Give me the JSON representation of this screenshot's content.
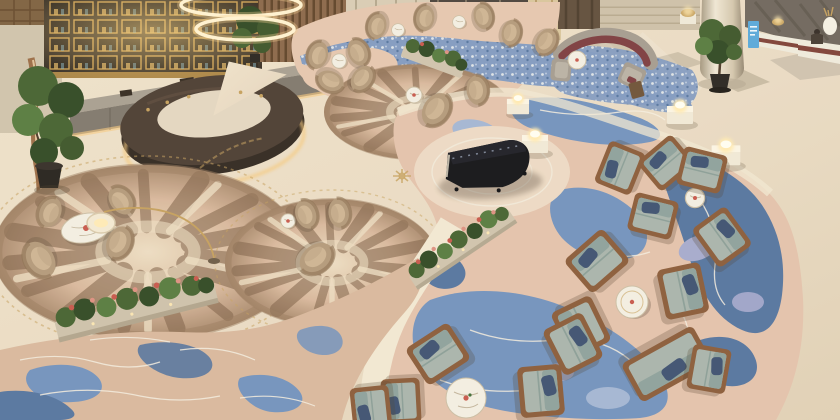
{
  "scene": {
    "title": "Hotel lobby lounge — overhead aerial view",
    "setting": "luxury hotel lobby with lounge bar, piano area and reception",
    "camera": "high-angle overhead photograph",
    "areas": [
      {
        "name": "bar-lounge",
        "description": "Illuminated gold display shelving, long grey back counter and dark marble horseshoe bar with warm under-counter lighting"
      },
      {
        "name": "chandelier",
        "description": "Two glowing LED ring chandeliers suspended above the bar"
      },
      {
        "name": "tan-seating",
        "description": "Tan barrel tub chairs with small round marble tables arranged on circular brush-stroke rugs"
      },
      {
        "name": "piano-stage",
        "description": "Black grand piano with open lid standing on a pale medallion of the blue marbled carpet"
      },
      {
        "name": "blue-carpet-lounge",
        "description": "Wood-frame armchairs with sage-green cushions and navy pillows around white marble tables on a blue-and-blush marbled carpet"
      },
      {
        "name": "reception",
        "description": "White stone reception desks with dark red accent band, attendant on duty and a blue standing information sign"
      },
      {
        "name": "greenery",
        "description": "Potted ficus trees and long planter boxes filled with red and pink flowers"
      }
    ],
    "objects": {
      "grand_piano": 1,
      "ring_chandeliers": 2,
      "tan_tub_chairs": 18,
      "wood_frame_armchairs": 13,
      "loveseat_sofas": 1,
      "curved_sofa_maroon": 1,
      "marble_tables": 11,
      "glowing_display_pedestals": 4,
      "flower_planters": 3,
      "potted_trees": 3,
      "reception_desks": 2,
      "staff": 1,
      "blue_info_sign": 1,
      "circular_rugs": 3
    }
  },
  "palette": {
    "floor": "#e9dac3",
    "floorWarm": "#f0e3cd",
    "walkway": "#f2e7d2",
    "wallBrown": "#7d5f3f",
    "goldShelf": "#c79a4e",
    "shelfDark": "#332a22",
    "counterGray": "#a79d90",
    "cabinetGray": "#7f766c",
    "barTop": "#4a3b31",
    "barDark": "#30261f",
    "barGlow": "#f6c87e",
    "woodSlat": "#8a6648",
    "travertine": "#cdbfa8",
    "wallDark": "#6e655c",
    "columnLight": "#e9dfcc",
    "carpetPink": "#e5c6ae",
    "carpetTan": "#d8b79c",
    "carpetBrown": "#9a7a5e",
    "carpetBrownDark": "#7c5e45",
    "carpetCream": "#ecdcc2",
    "blue": "#7191bd",
    "blueDark": "#54739f",
    "blueLight": "#a3b5d3",
    "blueMosaic": "#8199c0",
    "lavender": "#a5a9cd",
    "contour": "#f4ecdf",
    "chairTan": "#b3987a",
    "chairTanDark": "#8a6e50",
    "cushion": "#cdb392",
    "woodFrame": "#8a5a38",
    "sage": "#a8b3ab",
    "sageDark": "#8da09b",
    "navy": "#3d5070",
    "maroon": "#7c3a3f",
    "sofaGray": "#a49a8f",
    "marble": "#f3eee2",
    "brass": "#c59f5c",
    "piano": "#111116",
    "pedestal": "#f1e8d6",
    "glow": "#ffe9b2",
    "sign": "#58a7da",
    "green": "#44602f",
    "greenDark": "#2f4722",
    "pot": "#28231f",
    "flowerRed": "#c7564a",
    "flowerPink": "#dd8f80",
    "deskWhite": "#efe9dc",
    "deskMaroon": "#7e4036"
  }
}
